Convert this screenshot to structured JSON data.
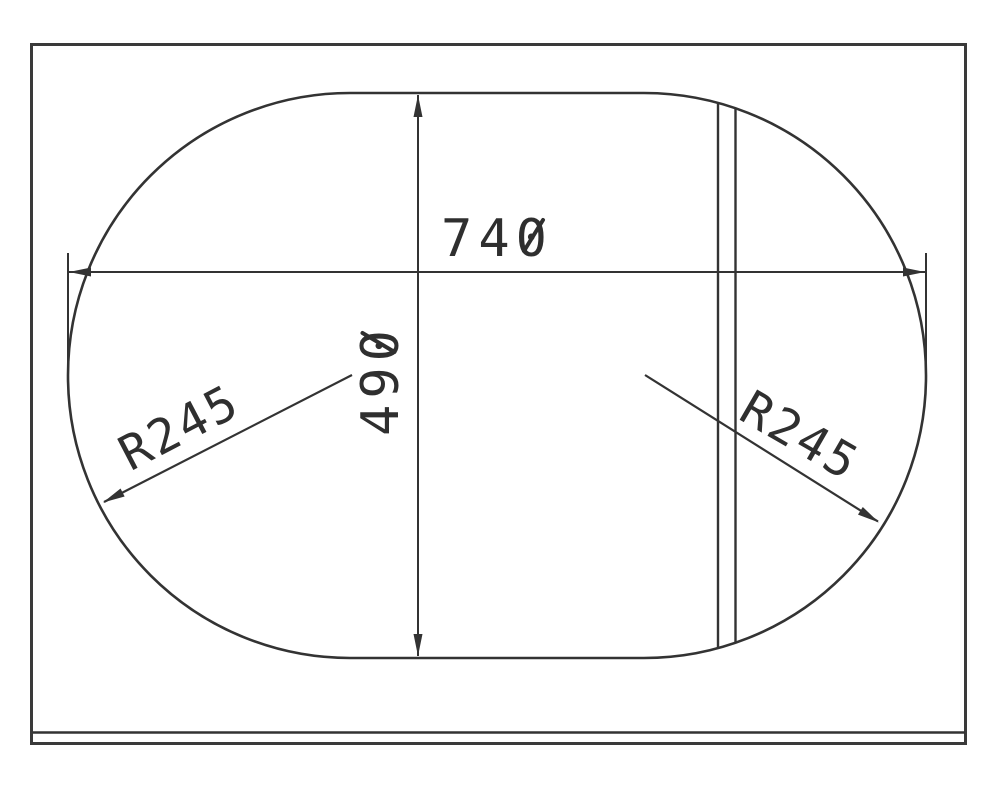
{
  "page": {
    "background_color": "#ffffff",
    "line_color": "#333333"
  },
  "drawing": {
    "labels": {
      "width": "740",
      "height": "490",
      "radius_left": "R245",
      "radius_right": "R245"
    }
  }
}
